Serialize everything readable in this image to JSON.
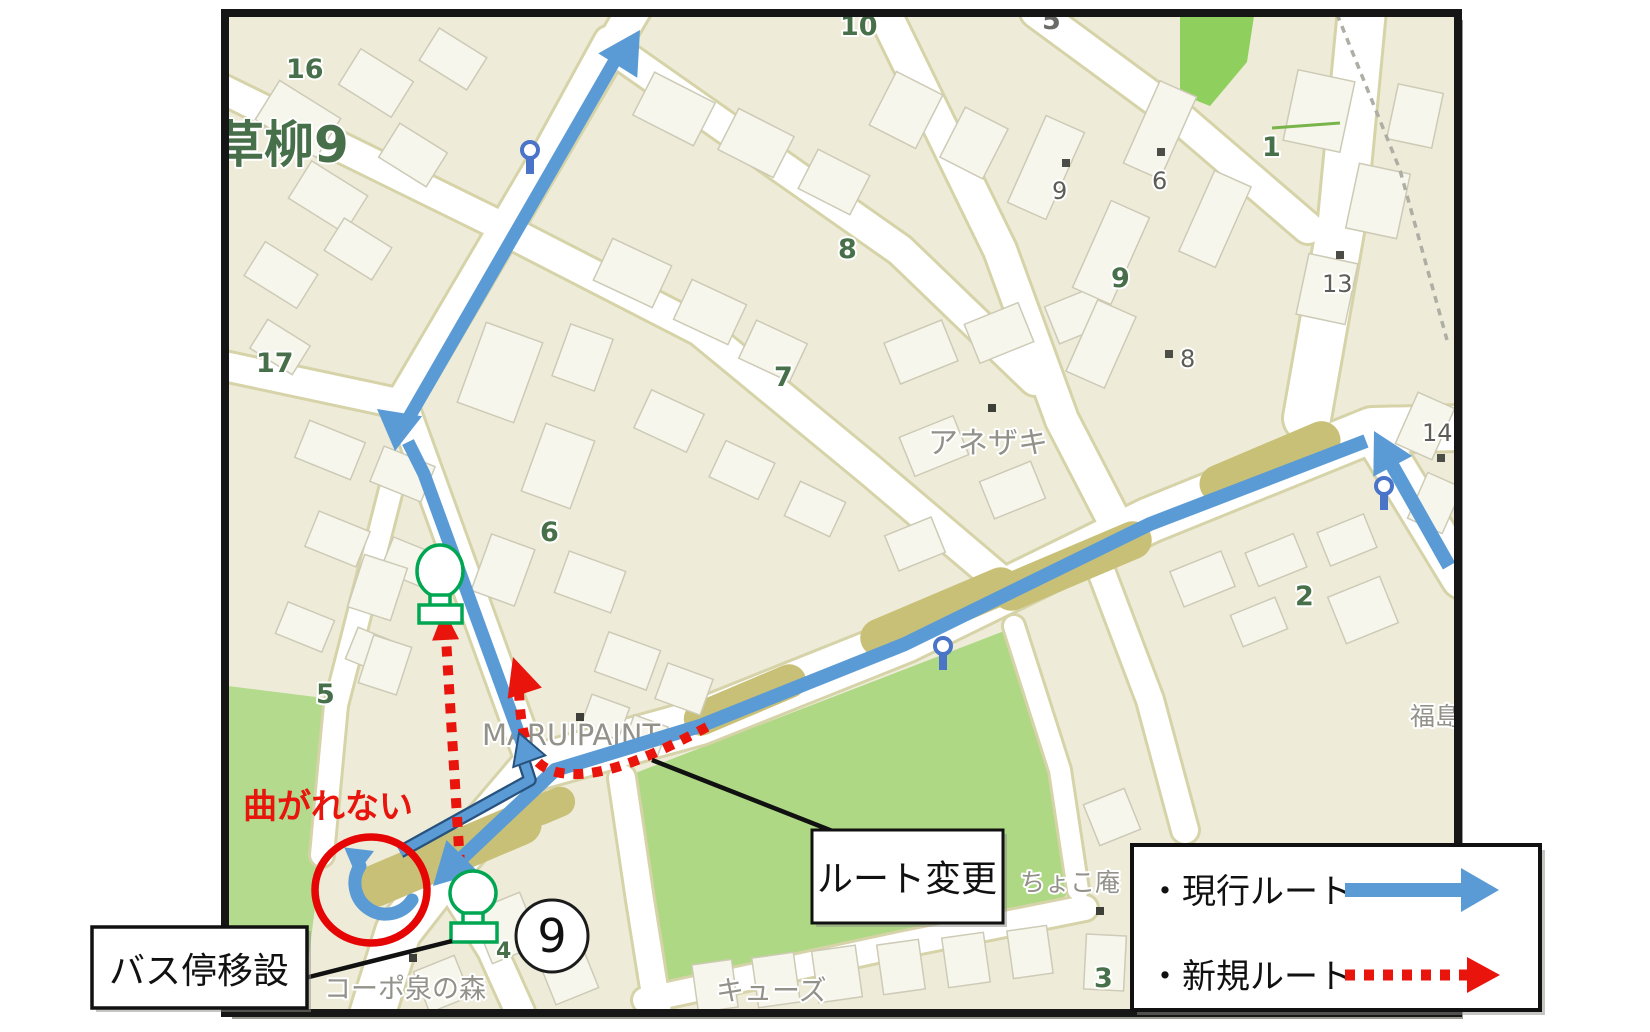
{
  "annotations": {
    "cannot_turn": "曲がれない",
    "route_change": "ルート変更",
    "bus_stop_relocation": "バス停移設",
    "stop_circle_number": "9"
  },
  "legend": {
    "current_route_label": "・現行ルート",
    "new_route_label": "・新規ルート",
    "current_route_color": "#5b9bd5",
    "new_route_color": "#e9150d"
  },
  "map": {
    "place_labels": [
      {
        "text": "草柳9",
        "x": 214,
        "y": 162,
        "size": 50,
        "color": "#47704a",
        "bold": true
      },
      {
        "text": "アネザキ",
        "x": 928,
        "y": 453,
        "size": 30,
        "color": "#92918a"
      },
      {
        "text": "MARUIPAINT",
        "x": 482,
        "y": 745,
        "size": 29,
        "color": "#92918a"
      },
      {
        "text": "コーポ泉の森",
        "x": 324,
        "y": 998,
        "size": 27,
        "color": "#92918a"
      },
      {
        "text": "キューズ",
        "x": 716,
        "y": 1000,
        "size": 28,
        "color": "#92918a"
      },
      {
        "text": "ちょこ庵",
        "x": 1020,
        "y": 891,
        "size": 25,
        "color": "#92918a"
      },
      {
        "text": "福島",
        "x": 1410,
        "y": 725,
        "size": 25,
        "color": "#92918a"
      }
    ],
    "block_numbers": [
      {
        "text": "16",
        "x": 286,
        "y": 78
      },
      {
        "text": "17",
        "x": 256,
        "y": 372
      },
      {
        "text": "5",
        "x": 316,
        "y": 703
      },
      {
        "text": "6",
        "x": 540,
        "y": 541
      },
      {
        "text": "7",
        "x": 774,
        "y": 386
      },
      {
        "text": "8",
        "x": 838,
        "y": 258
      },
      {
        "text": "9",
        "x": 1111,
        "y": 287
      },
      {
        "text": "10",
        "x": 840,
        "y": 35
      },
      {
        "text": "1",
        "x": 1262,
        "y": 156
      },
      {
        "text": "2",
        "x": 1295,
        "y": 605
      },
      {
        "text": "3",
        "x": 1094,
        "y": 987
      },
      {
        "text": "4",
        "x": 496,
        "y": 958,
        "size": 22
      },
      {
        "text": "5",
        "x": 1042,
        "y": 29,
        "color": "#6a6a66"
      }
    ],
    "house_numbers": [
      {
        "text": "9",
        "x": 1052,
        "y": 199,
        "dot": [
          1066,
          163
        ]
      },
      {
        "text": "6",
        "x": 1152,
        "y": 189,
        "dot": [
          1161,
          152
        ]
      },
      {
        "text": "13",
        "x": 1322,
        "y": 292,
        "dot": [
          1340,
          255
        ]
      },
      {
        "text": "8",
        "x": 1180,
        "y": 367,
        "dot": [
          1169,
          354
        ]
      },
      {
        "text": "14",
        "x": 1422,
        "y": 441,
        "dot": [
          1441,
          458
        ]
      }
    ],
    "poi_dots": [
      [
        992,
        408
      ],
      [
        580,
        717
      ],
      [
        1100,
        911
      ],
      [
        413,
        958
      ]
    ]
  }
}
